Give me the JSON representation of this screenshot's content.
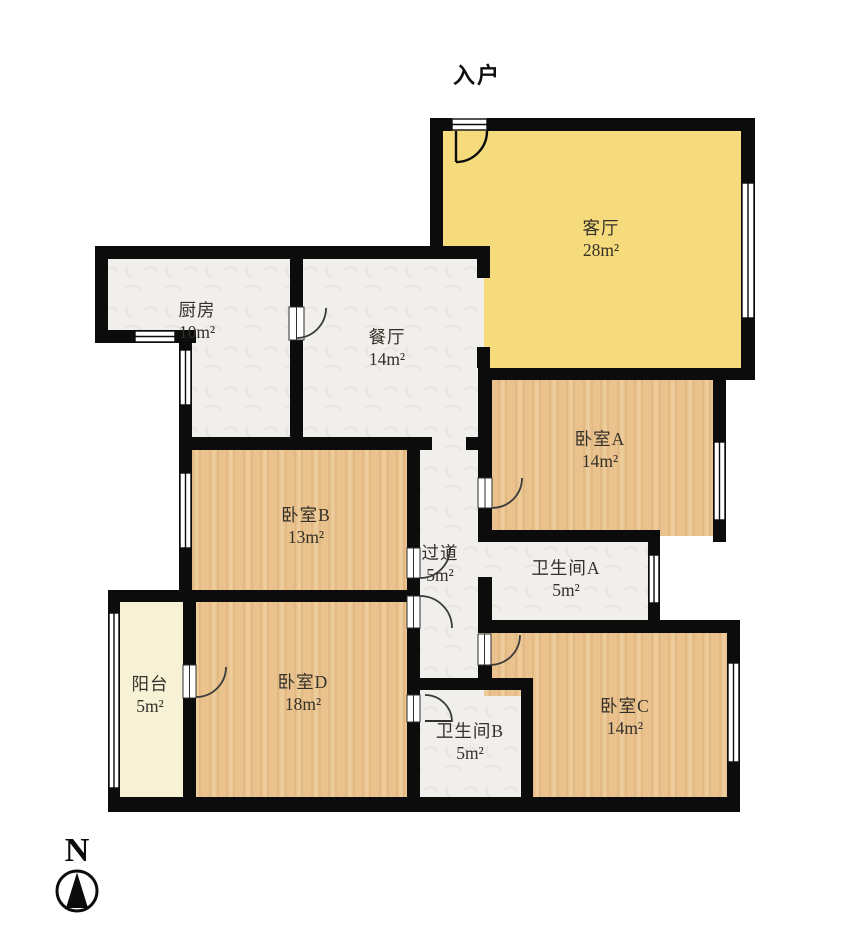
{
  "title": "入户",
  "compass": {
    "label": "N"
  },
  "rooms": [
    {
      "key": "living-room",
      "name": "客厅",
      "area": "28m²",
      "fill": "living"
    },
    {
      "key": "kitchen",
      "name": "厨房",
      "area": "10m²",
      "fill": "tile"
    },
    {
      "key": "dining-room",
      "name": "餐厅",
      "area": "14m²",
      "fill": "tile"
    },
    {
      "key": "bedroom-a",
      "name": "卧室A",
      "area": "14m²",
      "fill": "wood"
    },
    {
      "key": "bedroom-b",
      "name": "卧室B",
      "area": "13m²",
      "fill": "wood"
    },
    {
      "key": "hallway",
      "name": "过道",
      "area": "5m²",
      "fill": "tile"
    },
    {
      "key": "bathroom-a",
      "name": "卫生间A",
      "area": "5m²",
      "fill": "tile"
    },
    {
      "key": "bathroom-b",
      "name": "卫生间B",
      "area": "5m²",
      "fill": "tile"
    },
    {
      "key": "bedroom-c",
      "name": "卧室C",
      "area": "14m²",
      "fill": "wood"
    },
    {
      "key": "bedroom-d",
      "name": "卧室D",
      "area": "18m²",
      "fill": "wood"
    },
    {
      "key": "balcony",
      "name": "阳台",
      "area": "5m²",
      "fill": "cream"
    }
  ],
  "palette": {
    "wall": "#0c0c0c",
    "living": "#f5db7b",
    "wood": "#e9c28e",
    "tile": "#f1efec",
    "balcony": "#f7f2d6",
    "door_arc": "#3b3b3b",
    "label_text": "#35312a"
  }
}
